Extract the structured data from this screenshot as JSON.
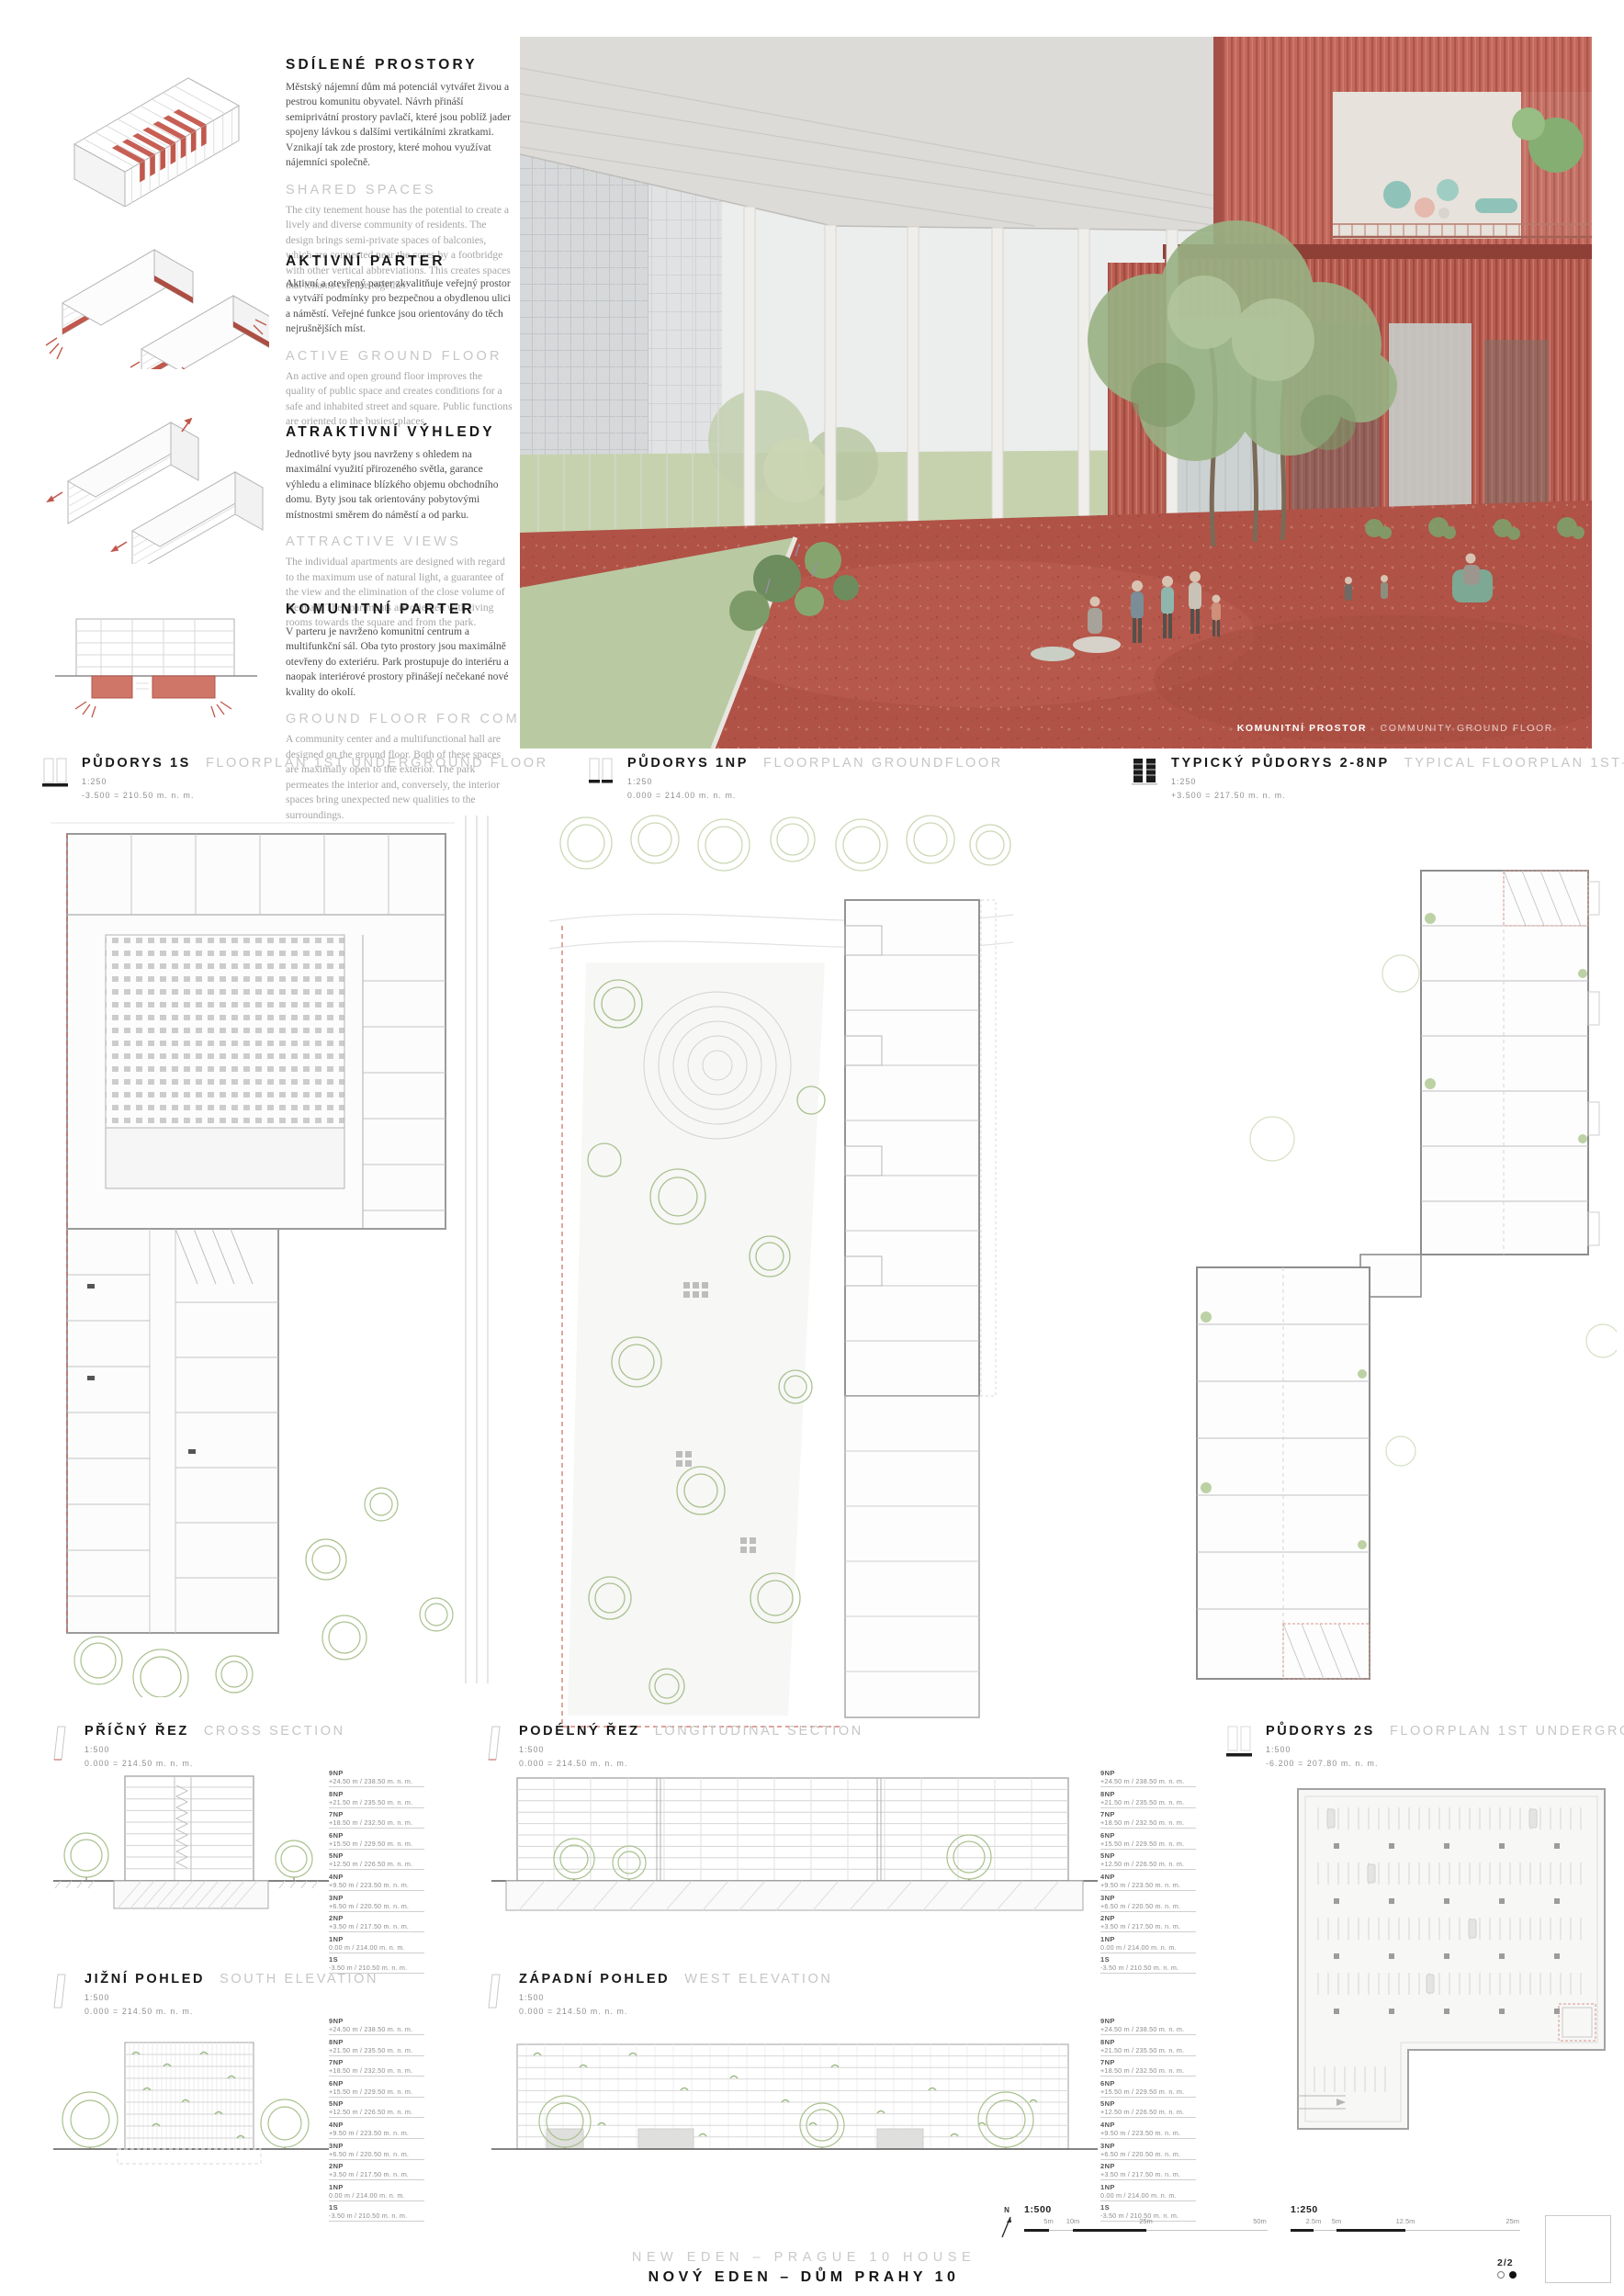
{
  "board": {
    "title_en": "NEW EDEN – PRAGUE 10 HOUSE",
    "title_cz": "NOVÝ EDEN – DŮM PRAHY 10",
    "page": "2/2"
  },
  "compass": {
    "label": "N"
  },
  "concepts": [
    {
      "title_cz": "SDÍLENÉ PROSTORY",
      "text_cz": "Městský nájemní dům má potenciál vytvářet živou a pestrou komunitu obyvatel. Návrh přináší semiprivátní prostory pavlačí, které jsou poblíž jader spojeny lávkou s dalšími vertikálními zkratkami. Vznikají tak zde prostory, které mohou využívat nájemníci společně.",
      "title_en": "SHARED SPACES",
      "text_en": "The city tenement house has the potential to create a lively and diverse community of residents. The design brings semi-private spaces of balconies, which are connected near the cores by a footbridge with other vertical abbreviations. This creates spaces that tenants can use together."
    },
    {
      "title_cz": "AKTIVNÍ PARTER",
      "text_cz": "Aktivní a otevřený parter zkvalitňuje veřejný prostor a vytváří podmínky pro bezpečnou a obydlenou ulici a náměstí. Veřejné funkce jsou orientovány do těch nejrušnějších míst.",
      "title_en": "ACTIVE GROUND FLOOR",
      "text_en": "An active and open ground floor improves the quality of public space and creates conditions for a safe and inhabited street and square. Public functions are oriented to the busiest places."
    },
    {
      "title_cz": "ATRAKTIVNÍ VÝHLEDY",
      "text_cz": "Jednotlivé byty jsou navrženy s ohledem na maximální využití přirozeného světla, garance výhledu a eliminace blízkého objemu obchodního domu. Byty jsou tak orientovány pobytovými místnostmi směrem do náměstí a od parku.",
      "title_en": "ATTRACTIVE VIEWS",
      "text_en": "The individual apartments are designed with regard to the maximum use of natural light, a guarantee of the view and the elimination of the close volume of the mall. The apartments are oriented with living rooms towards the square and from the park."
    },
    {
      "title_cz": "KOMUNITNÍ PARTER",
      "text_cz": "V parteru je navrženo komunitní centrum a multifunkční sál. Oba tyto prostory jsou maximálně otevřeny do exteriéru. Park prostupuje do interiéru a naopak interiérové prostory přinášejí nečekané nové kvality do okolí.",
      "title_en": "GROUND FLOOR FOR COMMUNITY",
      "text_en": "A community center and a multifunctional hall are designed on the ground floor. Both of these spaces are maximally open to the exterior. The park permeates the interior and, conversely, the interior spaces bring unexpected new qualities to the surroundings."
    }
  ],
  "rendering": {
    "caption_cz": "KOMUNITNÍ PROSTOR",
    "caption_en": "COMMUNITY GROUND FLOOR"
  },
  "plans": [
    {
      "title_cz": "PŮDORYS 1S",
      "title_en": "FLOORPLAN 1ST UNDERGROUND FLOOR",
      "scale": "1:250",
      "level": "-3.500 = 210.50 m. n. m."
    },
    {
      "title_cz": "PŮDORYS 1NP",
      "title_en": "FLOORPLAN GROUNDFLOOR",
      "scale": "1:250",
      "level": "0.000 = 214.00 m. n. m."
    },
    {
      "title_cz": "TYPICKÝ PŮDORYS 2-8NP",
      "title_en": "TYPICAL FLOORPLAN 1ST–8TH LEVEL",
      "scale": "1:250",
      "level": "+3.500 = 217.50 m. n. m."
    }
  ],
  "sections": [
    {
      "title_cz": "PŘÍČNÝ ŘEZ",
      "title_en": "CROSS SECTION",
      "scale": "1:500",
      "level": "0.000 = 214.50 m. n. m."
    },
    {
      "title_cz": "PODÉLNÝ ŘEZ",
      "title_en": "LONGITUDINAL SECTION",
      "scale": "1:500",
      "level": "0.000 = 214.50 m. n. m."
    },
    {
      "title_cz": "PŮDORYS 2S",
      "title_en": "FLOORPLAN 1ST UNDERGROUND FLOOR",
      "scale": "1:500",
      "level": "-6.200 = 207.80 m. n. m."
    },
    {
      "title_cz": "JIŽNÍ POHLED",
      "title_en": "SOUTH ELEVATION",
      "scale": "1:500",
      "level": "0.000 = 214.50 m. n. m."
    },
    {
      "title_cz": "ZÁPADNÍ POHLED",
      "title_en": "WEST ELEVATION",
      "scale": "1:500",
      "level": "0.000 = 214.50 m. n. m."
    }
  ],
  "levels": [
    {
      "floor": "9NP",
      "elev": "+24.50 m / 238.50 m. n. m."
    },
    {
      "floor": "8NP",
      "elev": "+21.50 m / 235.50 m. n. m."
    },
    {
      "floor": "7NP",
      "elev": "+18.50 m / 232.50 m. n. m."
    },
    {
      "floor": "6NP",
      "elev": "+15.50 m / 229.50 m. n. m."
    },
    {
      "floor": "5NP",
      "elev": "+12.50 m / 226.50 m. n. m."
    },
    {
      "floor": "4NP",
      "elev": "+9.50 m / 223.50 m. n. m."
    },
    {
      "floor": "3NP",
      "elev": "+6.50 m / 220.50 m. n. m."
    },
    {
      "floor": "2NP",
      "elev": "+3.50 m / 217.50 m. n. m."
    },
    {
      "floor": "1NP",
      "elev": "0.00 m / 214.00 m. n. m."
    },
    {
      "floor": "1S",
      "elev": "-3.50 m / 210.50 m. n. m."
    }
  ],
  "scalebars": [
    {
      "label": "1:500",
      "ticks": [
        "5m",
        "10m",
        "25m",
        "50m"
      ]
    },
    {
      "label": "1:250",
      "ticks": [
        "2.5m",
        "5m",
        "12.5m",
        "25m"
      ]
    }
  ],
  "colors": {
    "accent_red": "#c0584c",
    "render_wall_red": "#c2685c",
    "render_floor_red": "#b05246",
    "foliage_green": "#98b284",
    "linework_grey": "#bdbdbd"
  }
}
